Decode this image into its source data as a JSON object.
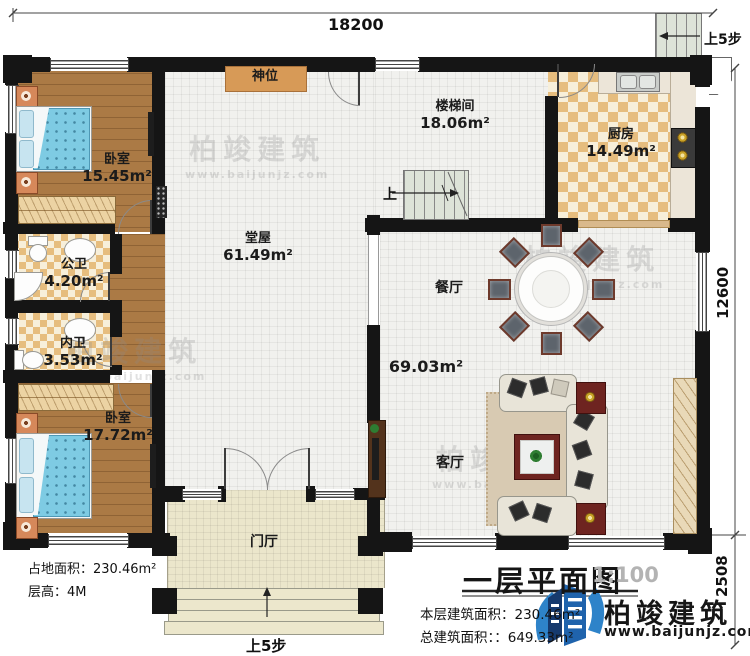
{
  "plan": {
    "dimensions": {
      "width_top": "18200",
      "height_right": "12600",
      "porch_right": "2508"
    },
    "rooms": {
      "bedroom1": {
        "name": "卧室",
        "area": "15.45m²"
      },
      "bedroom2": {
        "name": "卧室",
        "area": "17.72m²"
      },
      "hall": {
        "name": "堂屋",
        "area": "61.49m²"
      },
      "stairwell": {
        "name": "楼梯间",
        "area": "18.06m²"
      },
      "kitchen": {
        "name": "厨房",
        "area": "14.49m²"
      },
      "bath_public": {
        "name": "公卫",
        "area": "4.20m²"
      },
      "bath_private": {
        "name": "内卫",
        "area": "3.53m²"
      },
      "dining": {
        "name": "餐厅"
      },
      "living": {
        "name": "客厅"
      },
      "foyer": {
        "name": "门厅"
      },
      "shrine": {
        "name": "神位"
      },
      "open_area": {
        "area": "69.03m²"
      }
    },
    "stairs": {
      "up": "上",
      "up5_top": "上5步",
      "up5_bottom": "上5步"
    },
    "info": {
      "site_area_label": "占地面积：",
      "site_area_value": "230.46m²",
      "floor_height_label": "层高：",
      "floor_height_value": "4M"
    },
    "title_block": {
      "title": "一层平面图",
      "scale": "1:100",
      "floor_area_label": "本层建筑面积：",
      "floor_area_value": "230.46m²",
      "total_area_label": "总建筑面积：",
      "total_area_value": "：649.33m²",
      "brand": "柏竣建筑",
      "website": "www.baijunjz.com"
    },
    "watermark": {
      "brand": "柏竣建筑",
      "website": "www.baijunjz.com"
    },
    "colors": {
      "wall": "#151515",
      "wood_floor": "#ab7a45",
      "tile_checker_dark": "#e6bd7e",
      "tile_checker_light": "#f7efda",
      "bed_blue": "#7ecbe3",
      "brand_blue": "#1f63ac",
      "shrine_table": "#d79a57"
    }
  }
}
